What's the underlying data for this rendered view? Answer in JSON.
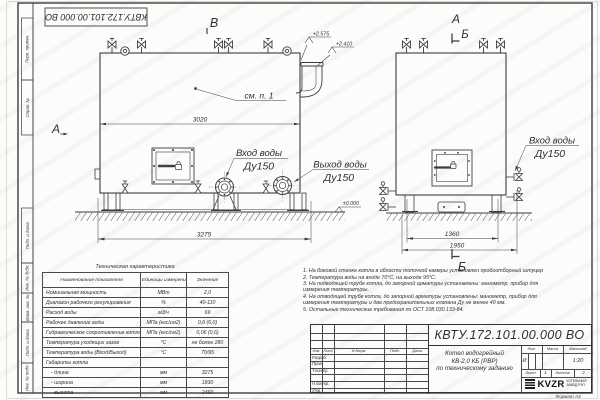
{
  "sheet": {
    "stamp_top": "КВТУ.172.101.00.000 ВО",
    "format_label": "Формат А3",
    "margin_labels": [
      "Перв. примен.",
      "Справ. №",
      "Подп. и дата",
      "Инв. № дубл.",
      "Взам. инв. №",
      "Подп. и дата",
      "Инв. № подл."
    ]
  },
  "views": {
    "front": {
      "view_label": "В",
      "callout_item": "см. п. 1",
      "dim_inner_width": "3020",
      "dim_overall_length": "3275",
      "elev_top1": "+2.575",
      "elev_top2": "+2.410",
      "elev_ground": "±0.000",
      "inlet_label": "Вход воды",
      "inlet_dn": "Ду150",
      "outlet_label": "Выход воды",
      "outlet_dn": "Ду150"
    },
    "side": {
      "view_label_top": "А",
      "section_label_top": "Б",
      "section_label_bottom": "Б",
      "view_label_left": "А",
      "dim_base_width": "1360",
      "dim_overall_width": "1950",
      "inlet_label": "Вход воды",
      "inlet_dn": "Ду150"
    }
  },
  "spec_table": {
    "title": "Техническая характеристика",
    "col_name": "Наименование показателя",
    "col_unit": "Единицы измерения",
    "col_value": "Значение",
    "rows": [
      {
        "name": "Номинальная мощность",
        "unit": "МВт",
        "value": "2,0"
      },
      {
        "name": "Диапазон рабочего регулирования",
        "unit": "%",
        "value": "40-110"
      },
      {
        "name": "Расход воды",
        "unit": "м3/ч",
        "value": "69"
      },
      {
        "name": "Рабочее давление воды",
        "unit": "МПа (кгс/см2)",
        "value": "0,6 (6,0)"
      },
      {
        "name": "Гидравлическое сопротивление котла",
        "unit": "МПа (кгс/см2)",
        "value": "0,06 (0,6)"
      },
      {
        "name": "Температура уходящих газов",
        "unit": "°С",
        "value": "не более 280"
      },
      {
        "name": "Температура воды (Вход/Выход)",
        "unit": "°С",
        "value": "70/95"
      },
      {
        "name": "Габариты котла",
        "unit": "",
        "value": ""
      },
      {
        "name": "- длина",
        "unit": "мм",
        "value": "3275"
      },
      {
        "name": "- ширина",
        "unit": "мм",
        "value": "1830"
      },
      {
        "name": "- высота",
        "unit": "мм",
        "value": "2460"
      }
    ]
  },
  "notes": [
    "1.  На боковой стенке котла в области топочной камеры установлен пробоотборный штуцер",
    "2.  Температура воды на входе 70°С, на выходе 95°С.",
    "3.  На подводящей трубе котла, до запорной арматуры установлены: манометр, прибор для измерения температуры.",
    "4.  На отводящей трубе котла, до запорной арматуры установлены: манометр, прибор для измерения температуры и два предохранительных клапана Ду не менее 40 мм.",
    "5.  Остальные технические требования по ОСТ 108.030.133-84."
  ],
  "title_block": {
    "doc_number": "КВТУ.172.101.00.000 ВО",
    "product_title_1": "Котел водогрейный",
    "product_title_2": "КВ-2,0 КБ (РВР)",
    "product_title_3": "по техническому заданию",
    "header_izm": "Изм.",
    "header_list": "Лист",
    "header_doc": "N докум.",
    "header_sign": "Подп.",
    "header_date": "Дата",
    "row_labels": [
      "Разраб.",
      "Пров.",
      "Т.контр.",
      "Н.контр.",
      "Утв."
    ],
    "lit_header": "Лит",
    "mass_header": "Масса",
    "scale_header": "Масштаб",
    "lit_value": "И",
    "scale_value": "1:20",
    "sheet_label": "Лист",
    "sheet_value": "1",
    "sheets_label": "Листов",
    "sheets_value": "2",
    "logo_text": "KVZR",
    "logo_sub1": "КОТЕЛЬНЫЙ",
    "logo_sub2": "ЗАВОД РЭП"
  }
}
